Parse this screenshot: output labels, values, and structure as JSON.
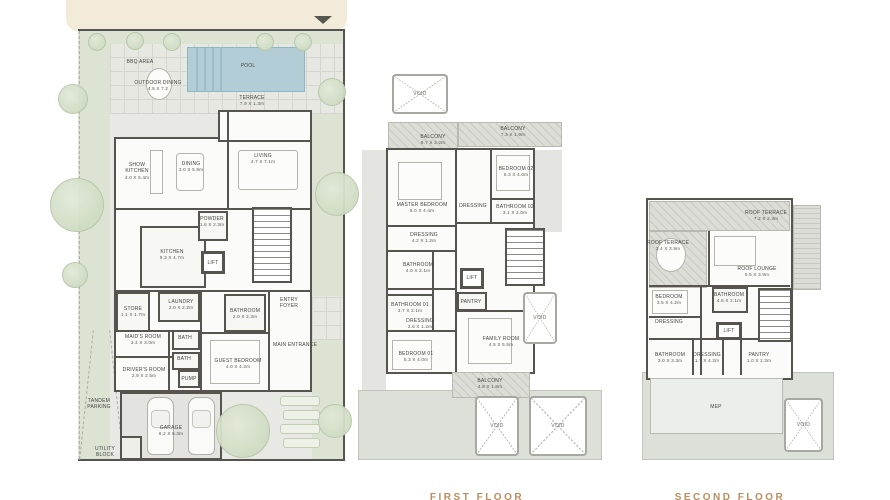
{
  "colors": {
    "wall": "#55544f",
    "cream_band": "#f2ebd9",
    "pool_blue": "#b3cdd7",
    "garden_green": "#dce3d3",
    "caption_tan": "#b98e5e",
    "label_gray": "#454542"
  },
  "ground": {
    "rooms": [
      {
        "name": "BBQ AREA",
        "dims": ""
      },
      {
        "name": "OUTDOOR DINING",
        "dims": "4.5 X 7.2"
      },
      {
        "name": "POOL",
        "dims": ""
      },
      {
        "name": "TERRACE",
        "dims": "7.9 X 1.3m"
      },
      {
        "name": "SHOW\nKITCHEN",
        "dims": "4.0 X 5.4m"
      },
      {
        "name": "DINING",
        "dims": "3.0 X 5.9m"
      },
      {
        "name": "LIVING",
        "dims": "4.7 X 7.1m"
      },
      {
        "name": "KITCHEN",
        "dims": "5.3 X 4.7m"
      },
      {
        "name": "POWDER",
        "dims": "1.6 X 2.3m"
      },
      {
        "name": "LIFT",
        "dims": ""
      },
      {
        "name": "STORE",
        "dims": "1.1 X 1.7m"
      },
      {
        "name": "LAUNDRY",
        "dims": "2.0 X 2.2m"
      },
      {
        "name": "MAID'S ROOM",
        "dims": "3.4 X 3.0m"
      },
      {
        "name": "BATH",
        "dims": ""
      },
      {
        "name": "BATH",
        "dims": ""
      },
      {
        "name": "DRIVER'S ROOM",
        "dims": "2.9 X 2.5m"
      },
      {
        "name": "PUMP",
        "dims": ""
      },
      {
        "name": "BATHROOM",
        "dims": "2.0 X 2.3m"
      },
      {
        "name": "GUEST BEDROOM",
        "dims": "4.0 X 4.2m"
      },
      {
        "name": "ENTRY\nFOYER",
        "dims": ""
      },
      {
        "name": "MAIN ENTRANCE",
        "dims": ""
      },
      {
        "name": "GARAGE",
        "dims": "6.2 X 6.3m"
      },
      {
        "name": "TANDEM\nPARKING",
        "dims": ""
      },
      {
        "name": "UTILITY\nBLOCK",
        "dims": ""
      }
    ]
  },
  "first": {
    "caption": "FIRST FLOOR",
    "rooms": [
      {
        "name": "VOID",
        "dims": ""
      },
      {
        "name": "BALCONY",
        "dims": "6.7 X 3.2m"
      },
      {
        "name": "BALCONY",
        "dims": "7.3 X 1.9m"
      },
      {
        "name": "MASTER BEDROOM",
        "dims": "6.0 X 4.4m"
      },
      {
        "name": "BEDROOM 02",
        "dims": "5.3 X 4.0m"
      },
      {
        "name": "DRESSING",
        "dims": ""
      },
      {
        "name": "BATHROOM 02",
        "dims": "3.1 X 2.0m"
      },
      {
        "name": "DRESSING",
        "dims": "4.2 X 1.2m"
      },
      {
        "name": "BATHROOM",
        "dims": "4.0 X 2.1m"
      },
      {
        "name": "LIFT",
        "dims": ""
      },
      {
        "name": "BATHROOM 01",
        "dims": "3.7 X 2.1m"
      },
      {
        "name": "PANTRY",
        "dims": ""
      },
      {
        "name": "DRESSING",
        "dims": "3.6 X 1.2m"
      },
      {
        "name": "BEDROOM 01",
        "dims": "5.3 X 4.0m"
      },
      {
        "name": "FAMILY ROOM",
        "dims": "4.5 X 5.5m"
      },
      {
        "name": "VOID",
        "dims": ""
      },
      {
        "name": "BALCONY",
        "dims": "4.8 X 1.8m"
      },
      {
        "name": "VOID",
        "dims": ""
      },
      {
        "name": "VOID",
        "dims": ""
      }
    ]
  },
  "second": {
    "caption": "SECOND FLOOR",
    "rooms": [
      {
        "name": "ROOF TERRACE",
        "dims": "7.2 X 2.3m"
      },
      {
        "name": "ROOF TERRACE",
        "dims": "3.4 X 3.9m"
      },
      {
        "name": "ROOF LOUNGE",
        "dims": "5.5 X 3.9m"
      },
      {
        "name": "BEDROOM",
        "dims": "3.5 X 4.2m"
      },
      {
        "name": "BATHROOM",
        "dims": "4.5 X 2.1m"
      },
      {
        "name": "DRESSING",
        "dims": ""
      },
      {
        "name": "LIFT",
        "dims": ""
      },
      {
        "name": "BATHROOM",
        "dims": "3.0 X 3.3m"
      },
      {
        "name": "DRESSING",
        "dims": "1.7 X 4.2m"
      },
      {
        "name": "PANTRY",
        "dims": "1.0 X 2.3m"
      },
      {
        "name": "MEP",
        "dims": ""
      },
      {
        "name": "VOID",
        "dims": ""
      }
    ]
  }
}
